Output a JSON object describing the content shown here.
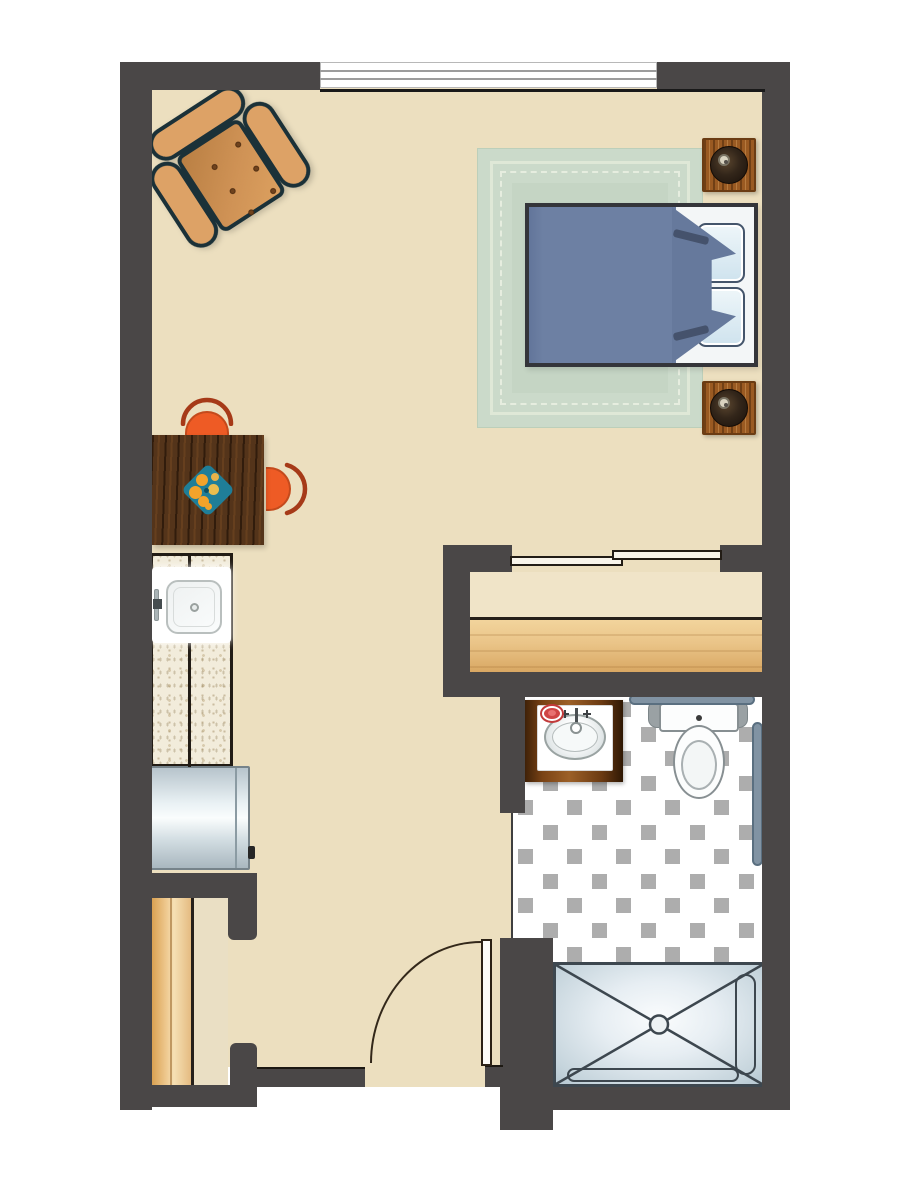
{
  "document": {
    "type": "floor-plan",
    "subject": "studio-apartment",
    "text_labels": []
  },
  "colors": {
    "wall": "#4a4747",
    "floor": "#ecdfbf",
    "outline": "#221c15",
    "rug": "#cbdaca",
    "rugBorder": "#dfe8d7",
    "rugField": "#c5d5c4",
    "bedFrame": "#34353a",
    "comforter": "#6d80a3",
    "comforterFold": "#66799c",
    "pillow": "#cfe3ee",
    "mattress": "#f3f6f7",
    "lampDark": "#19100a",
    "armchair": "#dda266",
    "armchairSeat": "#cf9255",
    "armchairOutline": "#1b3138",
    "chairOrange": "#ee5b25",
    "chairArc": "#a63a18",
    "centerpieceTeal": "#1f7e98",
    "fruit": "#f3a32a",
    "counter": "#f2ecdb",
    "sinkWhite": "#ffffff",
    "fridgeLight": "#fafdfd",
    "closetWoodShelf": "#eac488",
    "closetRod": "#eec88e",
    "slidingDoor": "#f8f4ea",
    "tileBase": "#ffffff",
    "tileDot": "#adadad",
    "vanityWood": "#7a4315",
    "soapRed": "#cf4444",
    "porcelain": "#fcfdfd",
    "fixtureOutline": "#878f92",
    "grabBar": "#8193a3",
    "showerPan": "#e7eef3",
    "showerOutline": "#3d474f",
    "doorLeaf": "#fdfcf8",
    "doorArc": "#33281a",
    "windowWhite": "#ffffff",
    "windowLine": "#9c9c9c",
    "sillBlack": "#191919"
  },
  "patterns": {
    "bath_tile": {
      "style": "octagon-dot",
      "cell": 49,
      "half": 24.5,
      "size": 15,
      "margin": 5
    }
  },
  "plan": {
    "rooms": [
      {
        "id": "living-sleeping-area",
        "contents": [
          "armchair",
          "dining-table",
          "two-chairs",
          "bed",
          "area-rug",
          "two-nightstands-with-lamps"
        ]
      },
      {
        "id": "kitchenette",
        "contents": [
          "counter-with-sink",
          "refrigerator"
        ]
      },
      {
        "id": "wardrobe-closet",
        "contents": [
          "sliding-doors",
          "shelf-with-rod"
        ]
      },
      {
        "id": "entry-closet",
        "contents": [
          "shelf-with-rod"
        ]
      },
      {
        "id": "bathroom",
        "contents": [
          "vanity-sink",
          "toilet",
          "grab-bars",
          "roll-in-shower-with-bench",
          "octagon-dot-tile"
        ]
      }
    ],
    "openings": [
      {
        "id": "window",
        "wall": "top"
      },
      {
        "id": "entry-door",
        "wall": "bottom",
        "swing": "inward-left"
      },
      {
        "id": "bathroom-doorway",
        "wall": "bathroom-left"
      }
    ]
  }
}
